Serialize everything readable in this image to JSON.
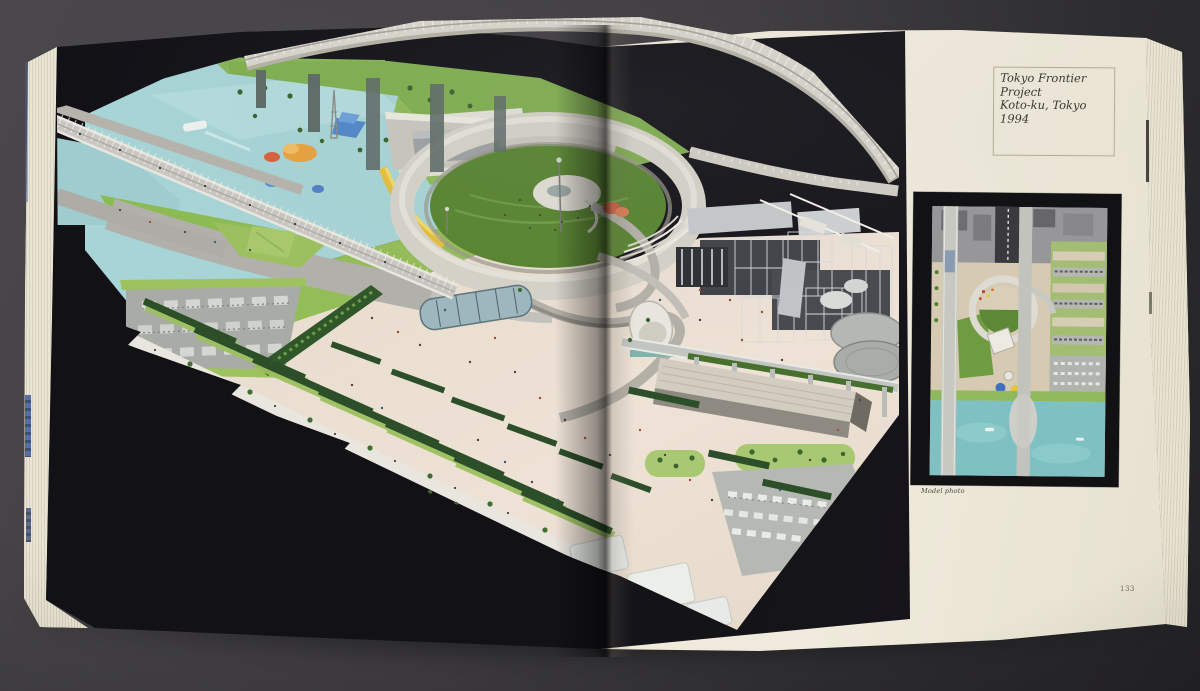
{
  "right_page": {
    "caption_box": {
      "title": "Tokyo Frontier Project",
      "location": "Koto-ku, Tokyo",
      "year": "1994"
    },
    "photo_caption": "Model photo",
    "page_number": "133"
  },
  "colors": {
    "table_background": "#3a383b",
    "page_black": "#131216",
    "paper_cream": "#efeadb",
    "water_blue": "#a7d4d6",
    "park_green": "#7fae4e",
    "plaza_beige": "#e9ddd0",
    "hedge_green": "#2c4f29",
    "viaduct_white": "#d8d5cb",
    "tank_gray": "#b0b3af",
    "plan_water": "#7fc0c2"
  }
}
